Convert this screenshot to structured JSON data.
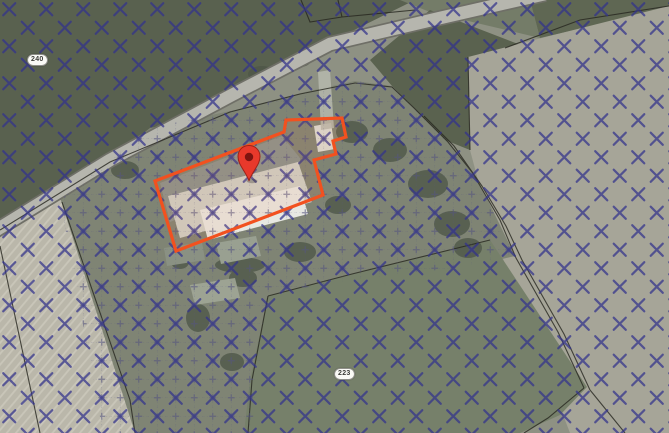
{
  "title": "Aerial cadastral map with selected parcel",
  "map": {
    "labels": [
      {
        "text": "240"
      },
      {
        "text": "223"
      }
    ],
    "marker": {
      "icon": "location-pin",
      "color": "#e8392b",
      "stroke_color": "#9c2318",
      "hole_color": "#7c1410"
    },
    "selected_parcel": {
      "outline_color": "#f2511f",
      "points": "155,181 284,132 286,120 342,118 346,137 333,141 336,154 314,160 323,195 176,251"
    },
    "overlays": {
      "cross_hatch": {
        "color": "#32328c",
        "spacing_px": 37
      },
      "plus_hatch": {
        "color": "#54547e",
        "spacing_px": 18.5,
        "area_points": "60,200 150,128 235,110 305,93 355,81 392,86 414,108 448,142 478,180 515,256 455,268 350,280 268,294 260,360 252,433 103,433"
      }
    }
  }
}
